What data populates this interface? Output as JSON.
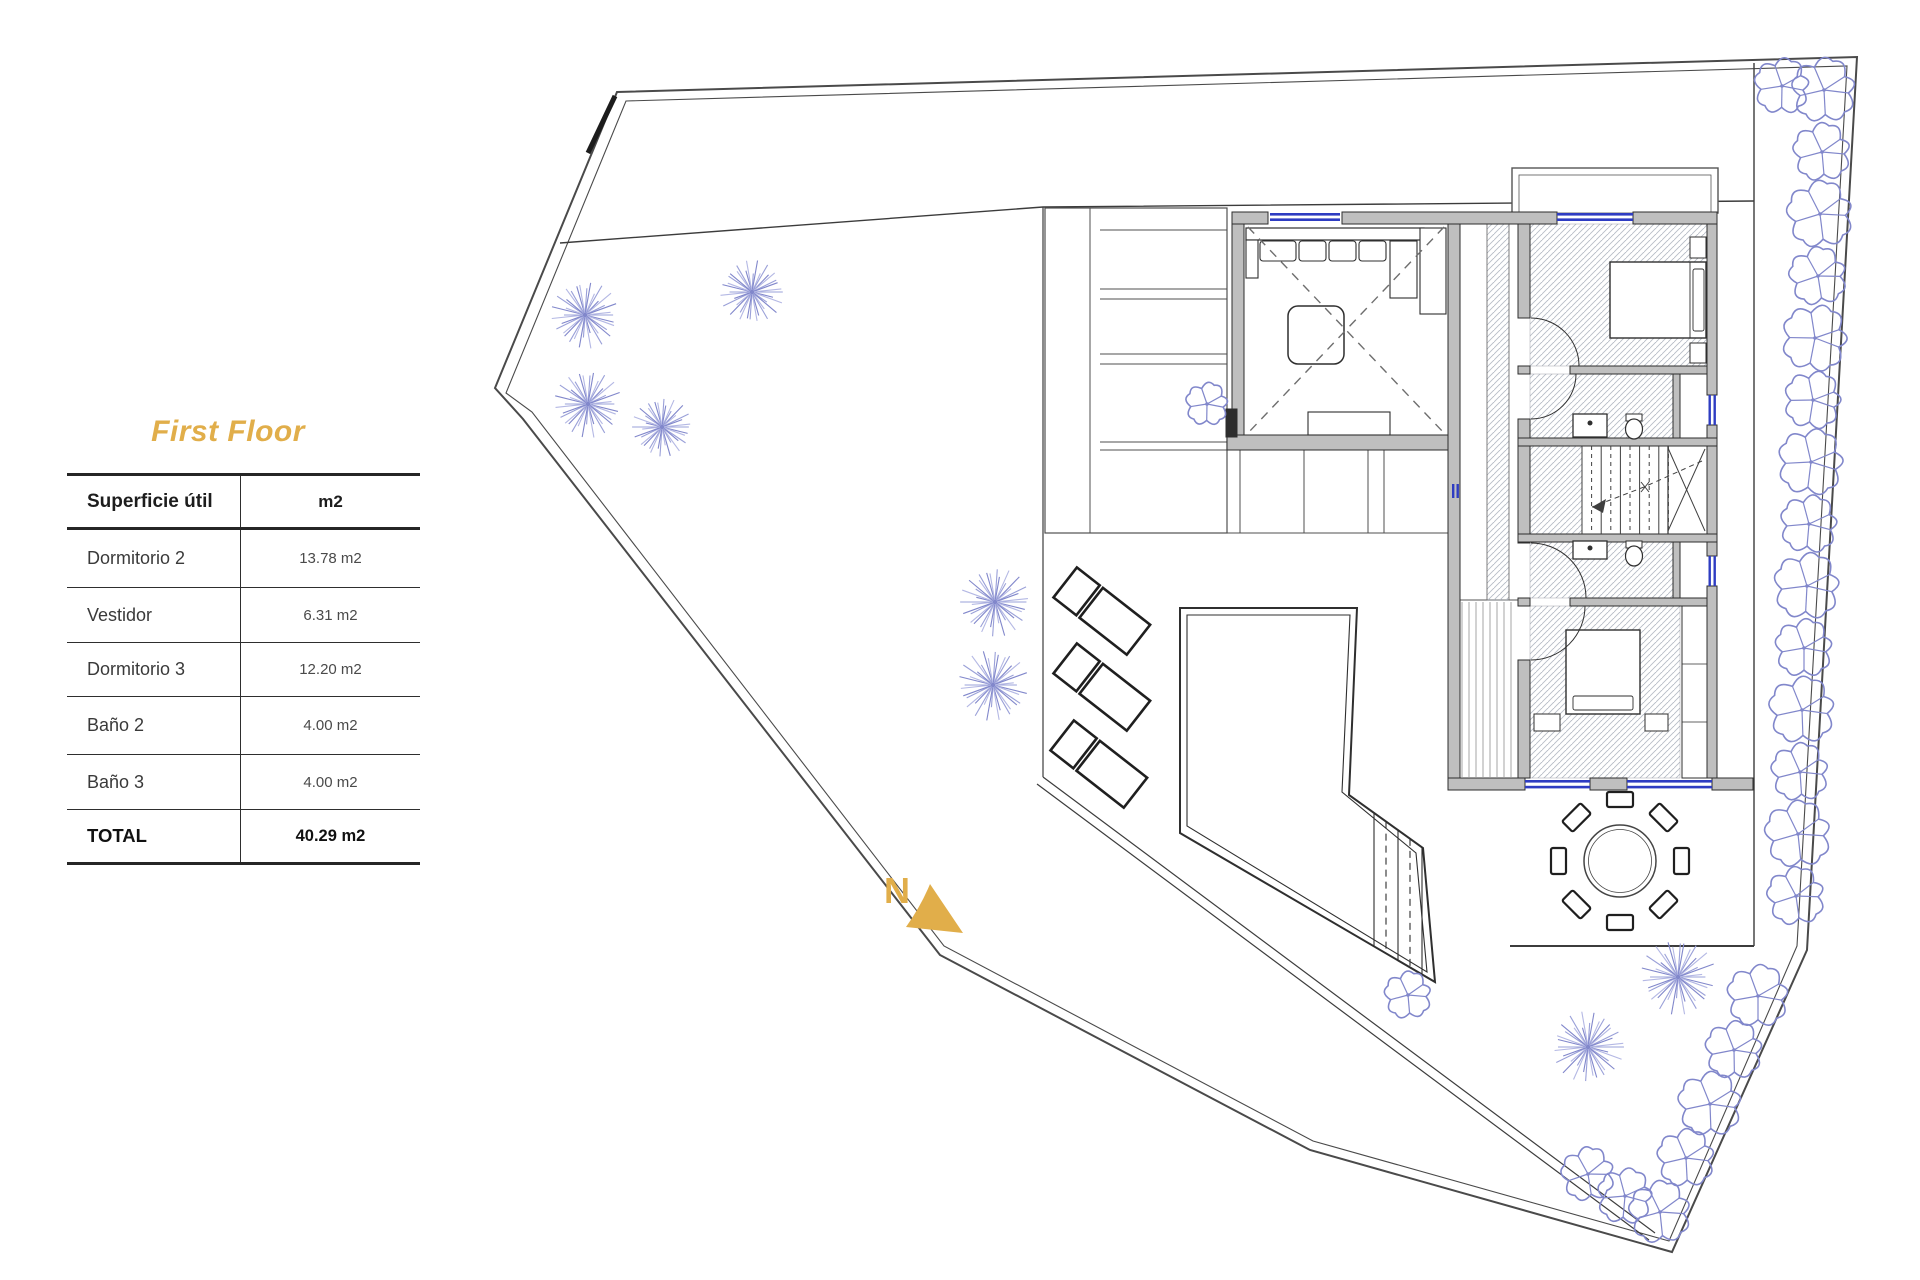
{
  "page": {
    "title_floor": "First Floor"
  },
  "table": {
    "header": {
      "label": "Superficie útil",
      "unit": "m2"
    },
    "rows": [
      {
        "label": "Dormitorio 2",
        "value": "13.78 m2"
      },
      {
        "label": "Vestidor",
        "value": "6.31 m2"
      },
      {
        "label": "Dormitorio 3",
        "value": "12.20 m2"
      },
      {
        "label": "Baño 2",
        "value": "4.00 m2"
      },
      {
        "label": "Baño 3",
        "value": "4.00 m2"
      }
    ],
    "total": {
      "label": "TOTAL",
      "value": "40.29 m2"
    }
  },
  "north": {
    "label": "N"
  },
  "colors": {
    "accent_gold": "#E1AE4A",
    "vegetation_violet": "#8A90CE",
    "wall_grey": "#BFBFBF",
    "window_blue": "#2E3CC2",
    "line_dark": "#3F3F3F"
  },
  "plan": {
    "dandelion_trees": [
      [
        585,
        315,
        34
      ],
      [
        752,
        292,
        32
      ],
      [
        588,
        404,
        34
      ],
      [
        662,
        427,
        30
      ],
      [
        995,
        602,
        35
      ],
      [
        993,
        685,
        36
      ],
      [
        1588,
        1047,
        36
      ],
      [
        1678,
        977,
        38
      ]
    ],
    "bushes": [
      [
        1782,
        86,
        26
      ],
      [
        1824,
        90,
        30
      ],
      [
        1822,
        152,
        27
      ],
      [
        1820,
        214,
        31
      ],
      [
        1818,
        276,
        27
      ],
      [
        1815,
        338,
        31
      ],
      [
        1813,
        400,
        27
      ],
      [
        1811,
        462,
        31
      ],
      [
        1809,
        524,
        27
      ],
      [
        1807,
        586,
        31
      ],
      [
        1804,
        648,
        27
      ],
      [
        1802,
        710,
        31
      ],
      [
        1800,
        772,
        27
      ],
      [
        1798,
        834,
        31
      ],
      [
        1796,
        896,
        27
      ],
      [
        1758,
        996,
        29
      ],
      [
        1734,
        1050,
        27
      ],
      [
        1710,
        1104,
        30
      ],
      [
        1686,
        1158,
        27
      ],
      [
        1660,
        1212,
        29
      ],
      [
        1625,
        1196,
        26
      ],
      [
        1588,
        1174,
        25
      ],
      [
        1408,
        995,
        22
      ],
      [
        1207,
        404,
        20
      ]
    ],
    "sun_loungers": [
      [
        1103,
        612
      ],
      [
        1103,
        688
      ],
      [
        1100,
        765
      ]
    ],
    "dining_chairs": 8
  }
}
